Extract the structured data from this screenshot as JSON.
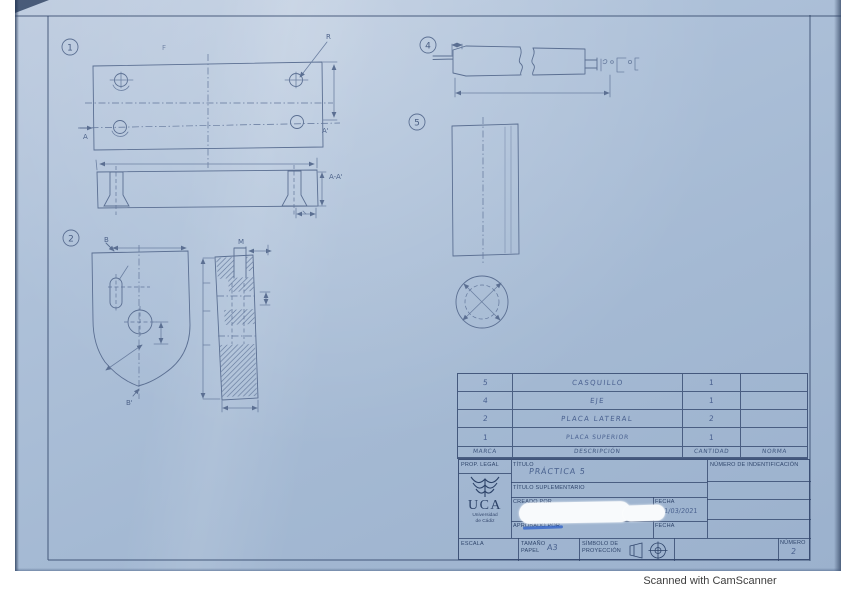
{
  "colors": {
    "paper": "#a9bed9",
    "pencil": "#5b6f92",
    "printed": "#2f456b",
    "scribble": "#3565c8",
    "edge_dark": "#24395c"
  },
  "drawings": {
    "balloon_1": "1",
    "balloon_2": "2",
    "balloon_4": "4",
    "balloon_5": "5",
    "labels": {
      "f": "F",
      "r": "R",
      "a": "A",
      "a_prime": "A'",
      "section_aa": "A-A'",
      "b": "B",
      "b_prime": "B'",
      "m": "M"
    }
  },
  "parts_table": {
    "headers": {
      "marca": "MARCA",
      "descripcion": "DESCRIPCIÓN",
      "cantidad": "CANTIDAD",
      "norma": "NORMA"
    },
    "rows": [
      {
        "marca": "5",
        "descripcion": "CASQUILLO",
        "cantidad": "1",
        "norma": ""
      },
      {
        "marca": "4",
        "descripcion": "EJE",
        "cantidad": "1",
        "norma": ""
      },
      {
        "marca": "2",
        "descripcion": "PLACA LATERAL",
        "cantidad": "2",
        "norma": ""
      },
      {
        "marca": "1",
        "descripcion": "PLACA SUPERIOR",
        "cantidad": "1",
        "norma": ""
      }
    ]
  },
  "title_block": {
    "prop_legal": "PROP. LEGAL",
    "logo_name": "UCA",
    "logo_sub1": "Universidad",
    "logo_sub2": "de Cádiz",
    "titulo_label": "TÍTULO",
    "titulo_value": "PRÁCTICA 5",
    "titulo_suplementario": "TÍTULO SUPLEMENTARIO",
    "creado_por": "CREADO POR",
    "aprobado_por": "APROBADO POR",
    "fecha_label_1": "FECHA",
    "fecha_value": "11/03/2021",
    "fecha_label_2": "FECHA",
    "numero_identificacion": "NÚMERO DE INDENTIFICACIÓN",
    "escala": "ESCALA",
    "tamano_line1": "TAMAÑO",
    "tamano_line2": "PAPEL",
    "tamano_value": "A3",
    "simbolo_line1": "SÍMBOLO DE",
    "simbolo_line2": "PROYECCIÓN",
    "numero_label": "NÚMERO",
    "numero_value": "2"
  },
  "footer": {
    "credit": "Scanned with CamScanner"
  }
}
